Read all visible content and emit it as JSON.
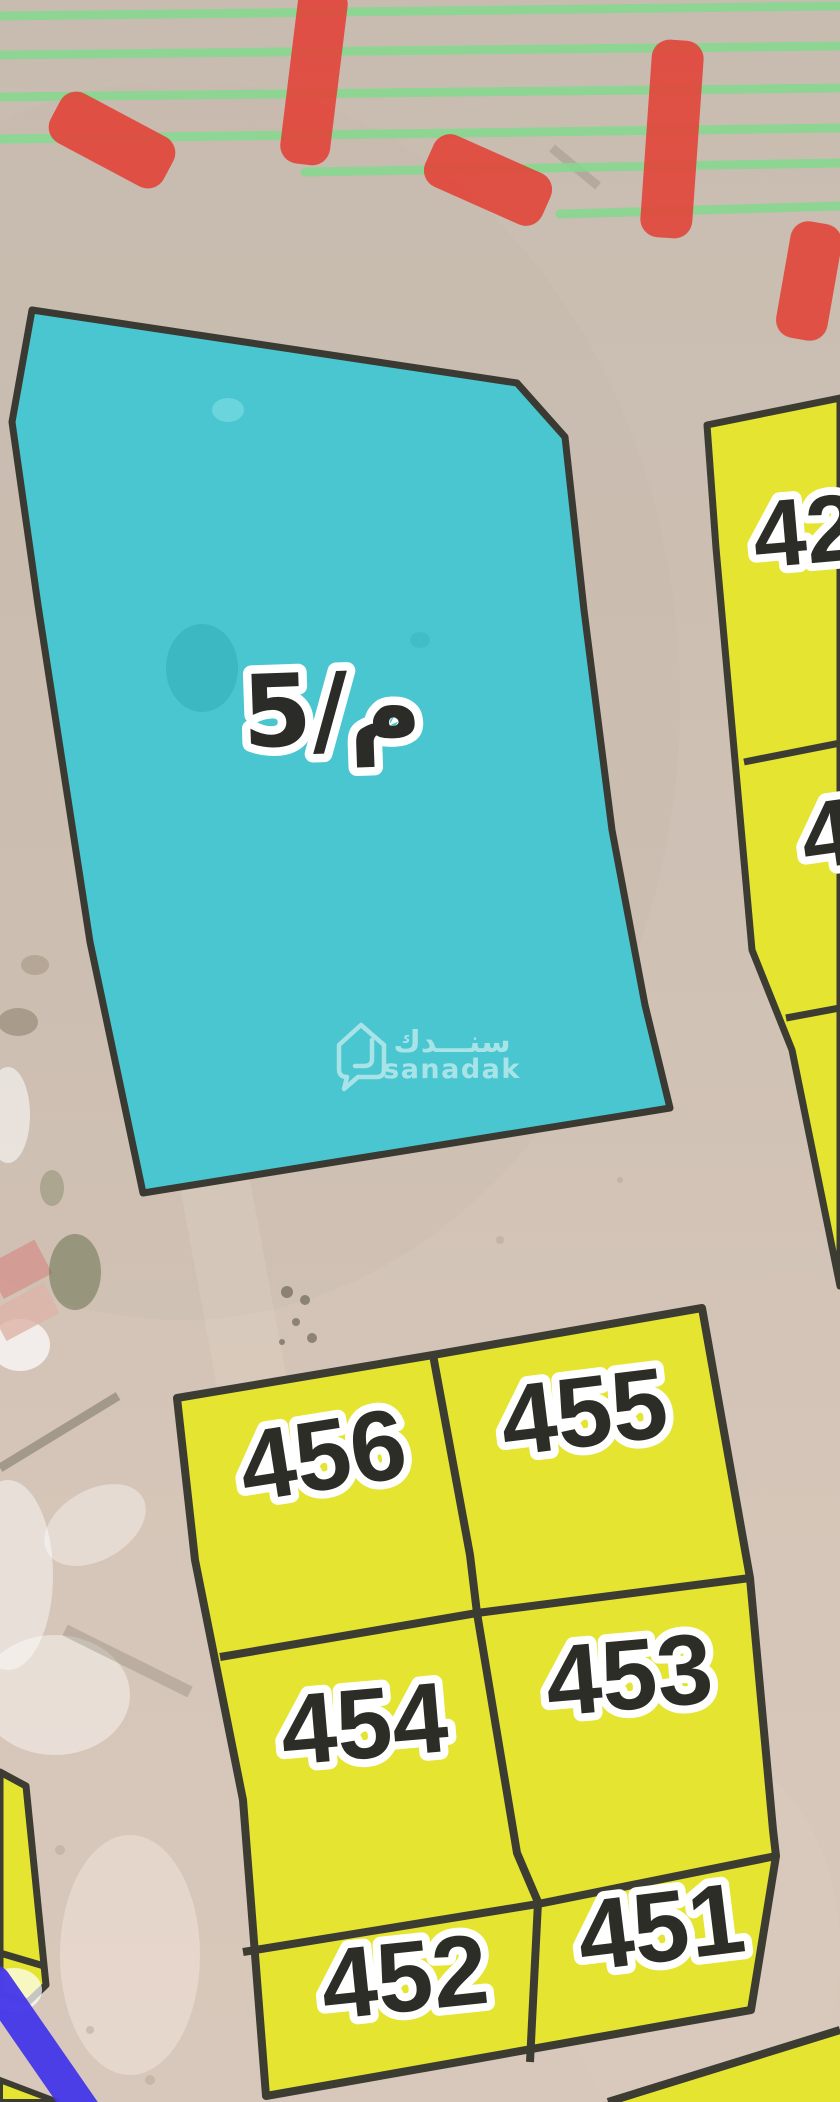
{
  "map": {
    "selected_parcel": {
      "label": "5/م",
      "fill": "#49c6d0",
      "border": "#3a3a33"
    },
    "parcels": {
      "fill": "#e4e431",
      "border": "#3c3c33",
      "p42": {
        "label": "42"
      },
      "p4x": {
        "label": "4"
      },
      "p456": {
        "label": "456"
      },
      "p455": {
        "label": "455"
      },
      "p454": {
        "label": "454"
      },
      "p453": {
        "label": "453"
      },
      "p452": {
        "label": "452"
      },
      "p451": {
        "label": "451"
      }
    },
    "watermark": {
      "brand_ar": "سنـــدك",
      "brand_en": "sanadak"
    },
    "colors": {
      "ground": "#c9bcb0",
      "ground_lower": "#d8c8bb",
      "red_dash": "#e1473d",
      "green_line": "#84da90",
      "blue_line": "#4537ea",
      "label_text": "#2d2d28",
      "label_halo": "#ffffff"
    }
  }
}
